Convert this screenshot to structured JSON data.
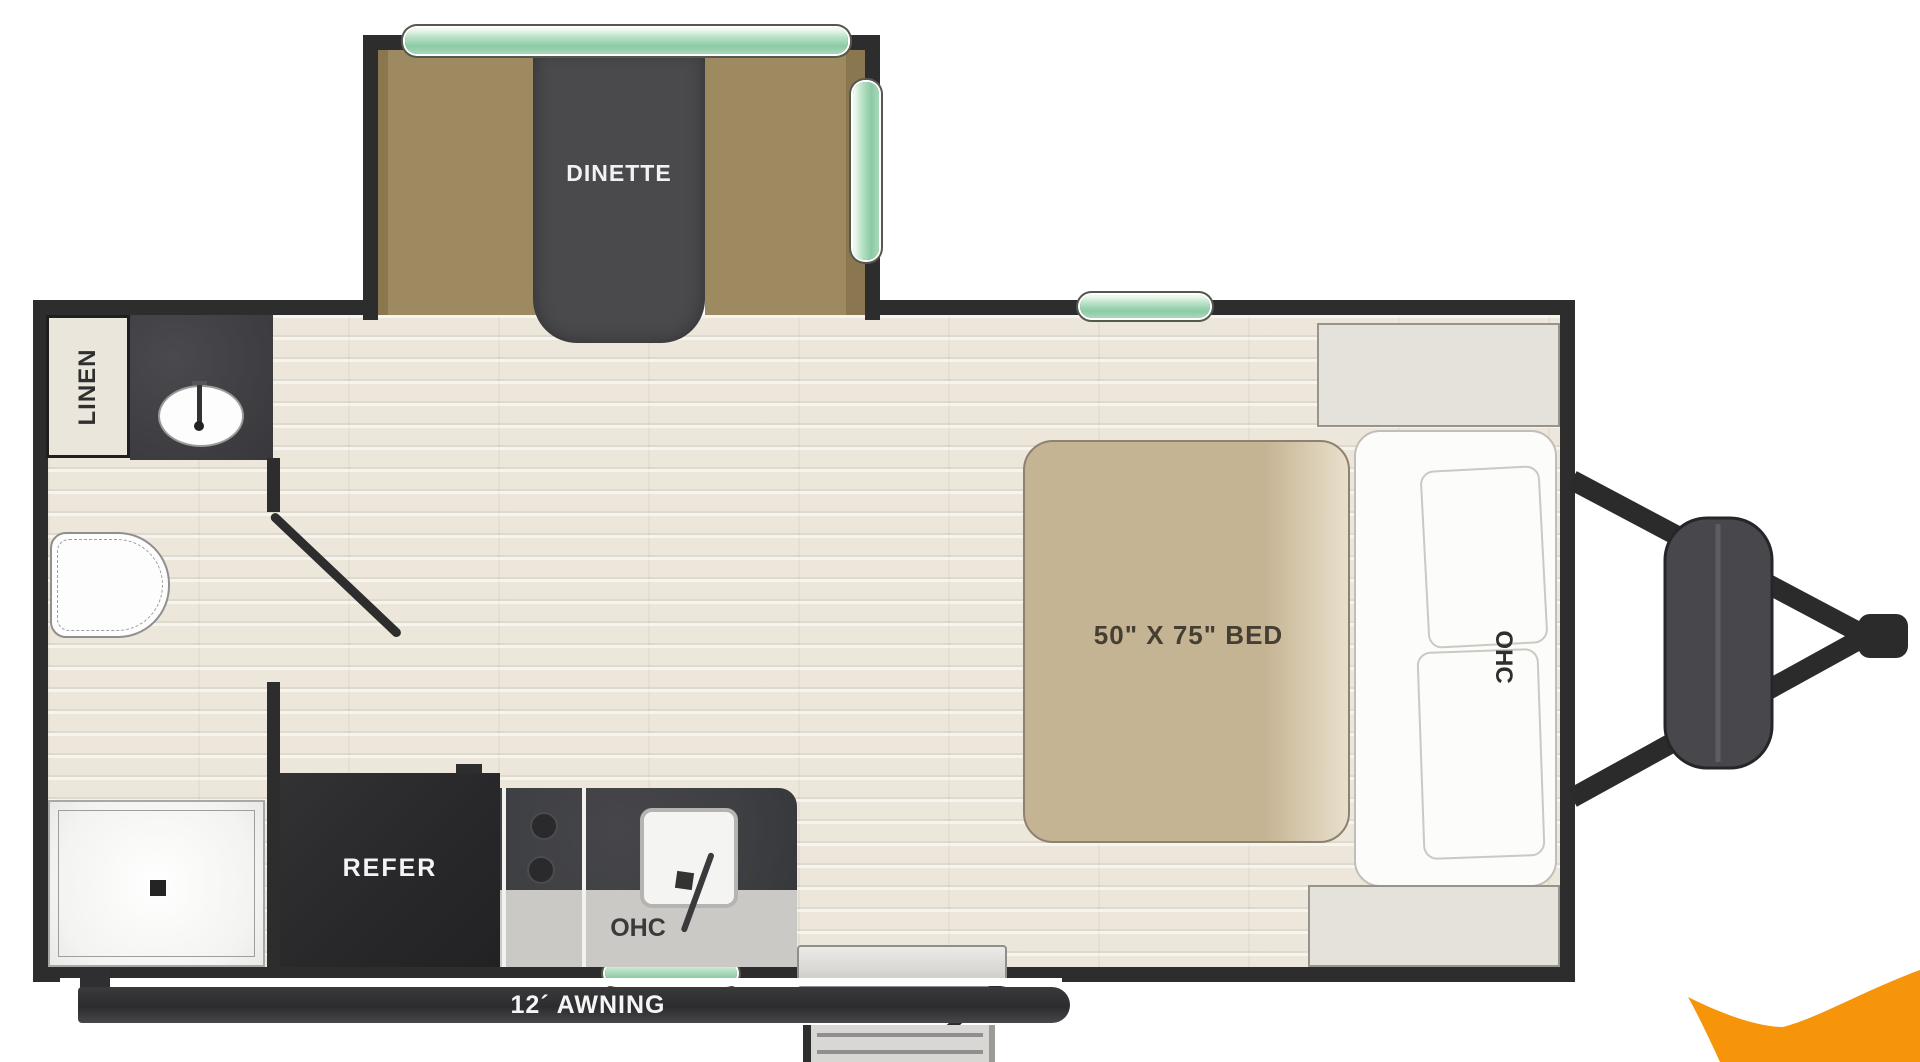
{
  "floorplan": {
    "title": "travel-trailer-floorplan",
    "labels": {
      "dinette": "DINETTE",
      "linen": "LINEN",
      "refrigerator": "REFER",
      "kitchen_overhead_cabinet": "OHC",
      "bedroom_overhead_cabinet": "OHC",
      "bed": "50\" X 75\" BED",
      "awning": "12´ AWNING"
    },
    "colors": {
      "wall": "#2d2d2d",
      "floor": "#ece7da",
      "bench_brown": "#9d8a61",
      "table_dark": "#4a4a4d",
      "window_green": "#8ccaa5",
      "bed_tan": "#c5b493",
      "counter_dark": "#3f4043",
      "counter_band": "#cac9c5",
      "appliance_dark": "#28282a",
      "cabinet_white": "#fcfcfb",
      "storage_gray": "#e4e2db",
      "brand_orange": "#f6950a"
    },
    "fixtures": [
      "dinette-slideout",
      "linen-closet",
      "vanity-sink",
      "toilet",
      "shower",
      "refrigerator",
      "cooktop",
      "kitchen-sink",
      "overhead-cabinet-kitchen",
      "entry-door",
      "entry-steps",
      "awning",
      "bed",
      "overhead-cabinet-bedroom",
      "front-storage",
      "propane-tanks",
      "a-frame-hitch"
    ]
  }
}
